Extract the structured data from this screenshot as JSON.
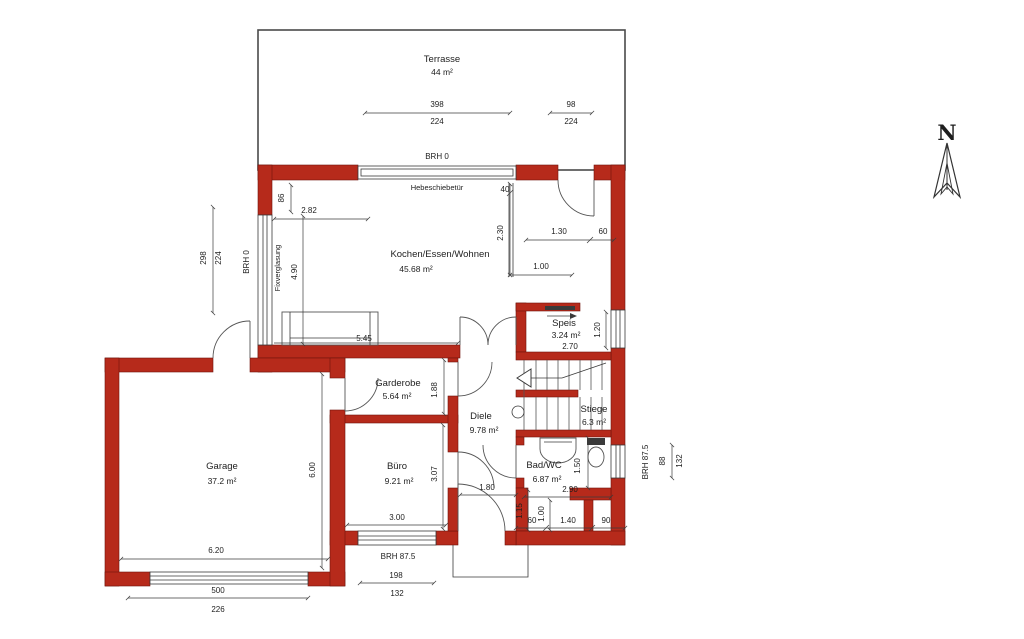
{
  "title": "Grundriss Erdgeschoss",
  "north_indicator": {
    "label": "N"
  },
  "rooms": [
    {
      "name": "Terrasse",
      "area": "44 m²"
    },
    {
      "name": "Kochen/Essen/Wohnen",
      "area": "45.68 m²"
    },
    {
      "name": "Speis",
      "area": "3.24 m²"
    },
    {
      "name": "Garderobe",
      "area": "5.64 m²"
    },
    {
      "name": "Diele",
      "area": "9.78 m²"
    },
    {
      "name": "Stiege",
      "area": "6.3 m²"
    },
    {
      "name": "Bad/WC",
      "area": "6.87 m²"
    },
    {
      "name": "Büro",
      "area": "9.21 m²"
    },
    {
      "name": "Garage",
      "area": "37.2 m²"
    }
  ],
  "annotations": {
    "hebeschiebetuer": "Hebeschiebetür",
    "fixverglasung": "Fixverglasung",
    "brh_top": "BRH 0",
    "brh_west": "BRH 0",
    "brh_south": "BRH 87.5",
    "brh_east": "BRH 87.5"
  },
  "dims": {
    "terrace_width_m": "398",
    "terrace_width_cm": "224",
    "terrace_door_m": "98",
    "terrace_door_cm": "224",
    "west_win_a": "298",
    "west_win_b": "224",
    "win_offset": "86",
    "fix_glazing_height": "4.90",
    "kitchen_width": "2.82",
    "niche": "40",
    "kitchen_depth": "2.30",
    "counter_a": "1.30",
    "counter_b": "60",
    "counter_c": "1.00",
    "living_bottom": "5.45",
    "speis_width": "2.70",
    "speis_depth": "1.20",
    "garderobe_depth": "1.88",
    "diele_width": "1.80",
    "badwc_width": "2.90",
    "badwc_depth": "1.50",
    "vest_a": "1.15",
    "vest_b": "1.00",
    "vest_c": "60",
    "vest_d": "1.40",
    "vest_e": "90",
    "buero_depth": "3.07",
    "buero_width": "3.00",
    "garage_width": "6.20",
    "garage_depth": "6.00",
    "garage_door_a": "500",
    "garage_door_b": "226",
    "buero_win_a": "198",
    "buero_win_b": "132",
    "east_win_a": "88",
    "east_win_b": "132"
  },
  "colors": {
    "wall": "#b62a1b",
    "line": "#3c3c3c",
    "background": "#ffffff"
  }
}
